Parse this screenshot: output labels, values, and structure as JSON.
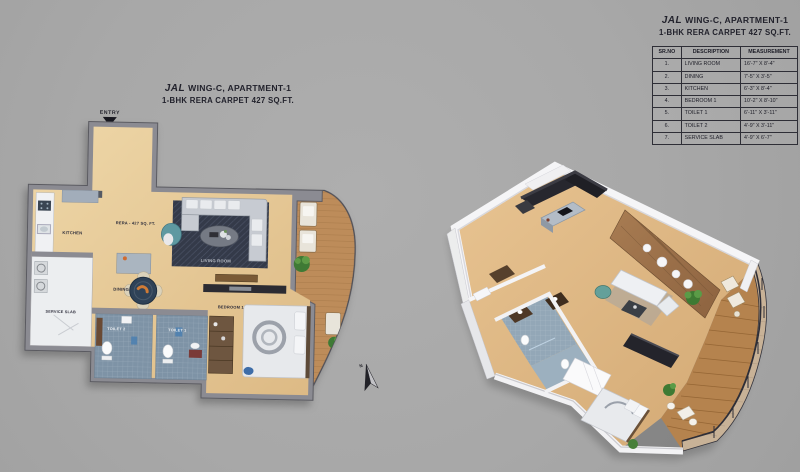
{
  "header": {
    "brand": "JAL",
    "title": "WING-C, APARTMENT-1",
    "subtitle": "1-BHK RERA CARPET 427 SQ.FT."
  },
  "plan2d": {
    "entry_label": "ENTRY",
    "north_label": "N",
    "area_label": "RERA - 427 SQ. FT.",
    "rooms": {
      "kitchen": "KITCHEN",
      "living": "LIVING ROOM",
      "dining": "DINING",
      "service": "SERVICE SLAB",
      "toilet2": "TOILET 2",
      "toilet1": "TOILET 1",
      "bedroom": "BEDROOM 1"
    }
  },
  "measurements": {
    "headers": [
      "SR.NO",
      "DESCRIPTION",
      "MEASUREMENT"
    ],
    "rows": [
      {
        "no": "1.",
        "desc": "LIVING ROOM",
        "size": "16'-7\" X 8'-4\""
      },
      {
        "no": "2.",
        "desc": "DINING",
        "size": "7'-5\" X 3'-5\""
      },
      {
        "no": "3.",
        "desc": "KITCHEN",
        "size": "6'-3\" X 8'-4\""
      },
      {
        "no": "4.",
        "desc": "BEDROOM 1",
        "size": "10'-2\" X 8'-10\""
      },
      {
        "no": "5.",
        "desc": "TOILET 1",
        "size": "6'-11\" X 3'-11\""
      },
      {
        "no": "6.",
        "desc": "TOILET 2",
        "size": "4'-9\" X 3'-11\""
      },
      {
        "no": "7.",
        "desc": "SERVICE SLAB",
        "size": "4'-9\" X 6'-7\""
      }
    ]
  },
  "colors": {
    "background": "#a9a9a9",
    "wall": "#8b8b92",
    "wood_floor": "#e3c493",
    "deck": "#b5834e",
    "rug": "#333948",
    "toilet_tile": "#7e93a6",
    "text": "#22222c"
  }
}
